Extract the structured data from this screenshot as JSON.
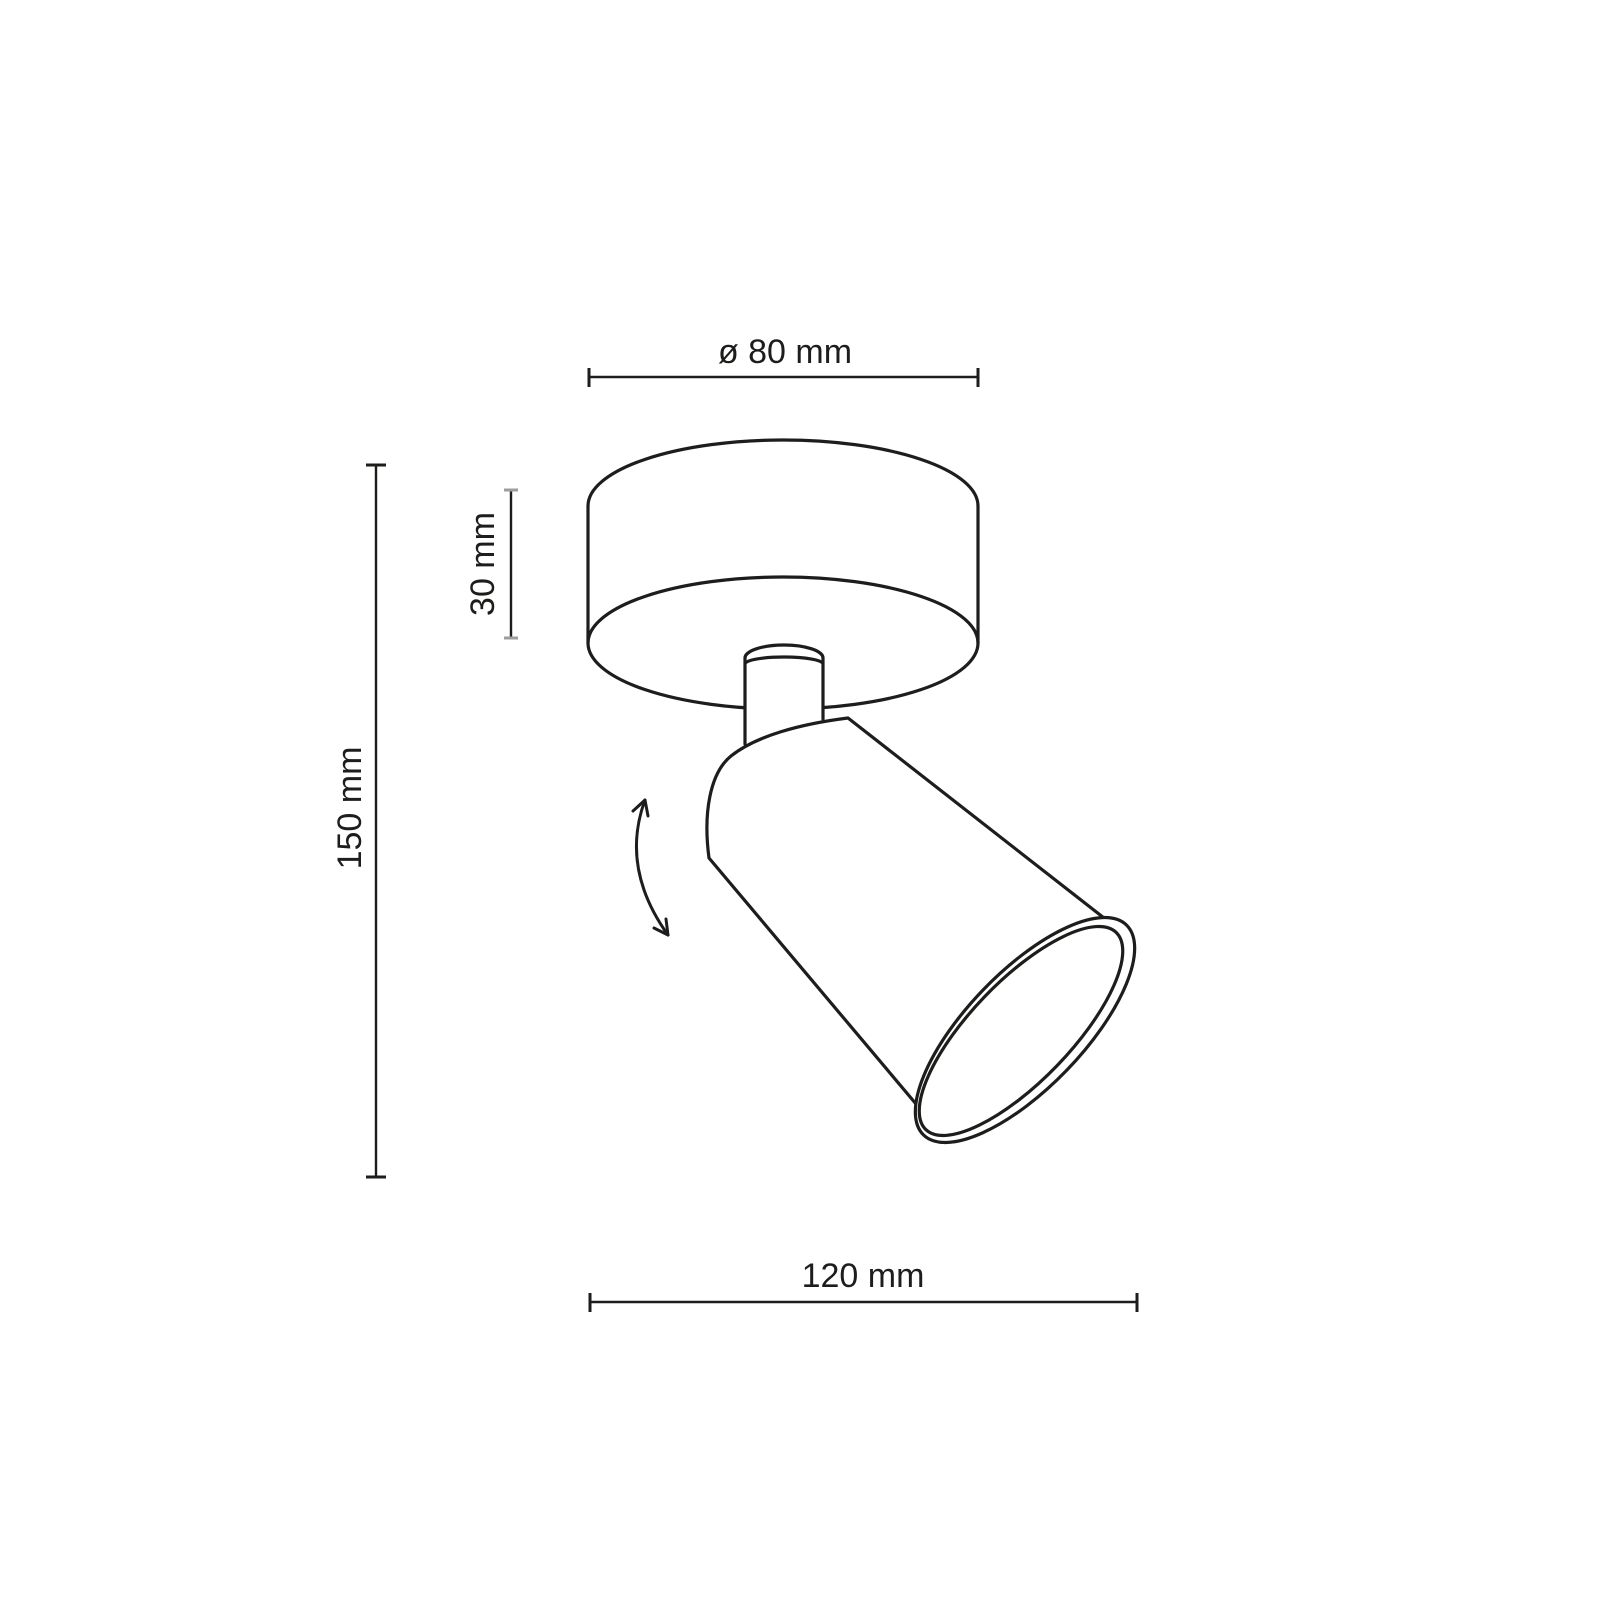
{
  "diagram": {
    "kind": "technical-dimension-drawing",
    "dimensions": {
      "diameter": {
        "label": "ø 80 mm"
      },
      "canopy_height": {
        "label": "30 mm"
      },
      "overall_height": {
        "label": "150 mm"
      },
      "overall_width": {
        "label": "120 mm"
      }
    },
    "colors": {
      "background": "#ffffff",
      "line": "#1d1d1b",
      "tick_gray": "#9d9d9c"
    }
  }
}
